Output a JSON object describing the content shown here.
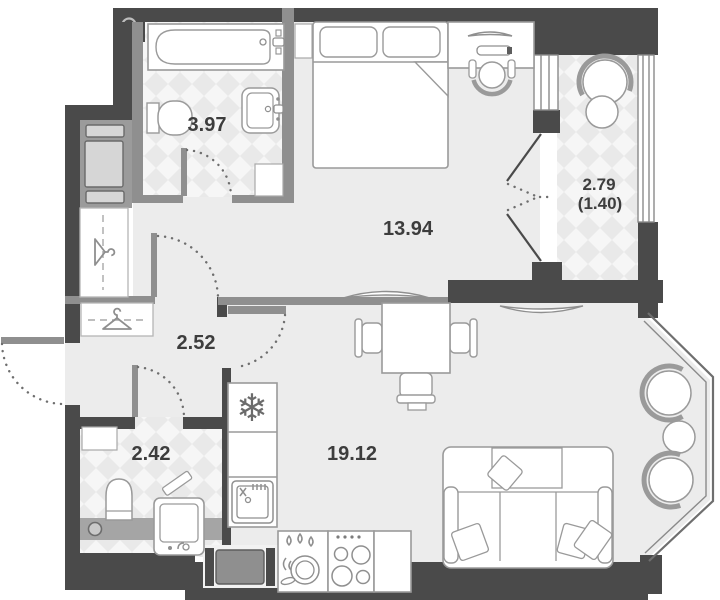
{
  "plan": {
    "type": "apartment-floor-plan",
    "rooms": [
      {
        "id": "bathroom",
        "area": "3.97"
      },
      {
        "id": "bedroom",
        "area": "13.94"
      },
      {
        "id": "balcony",
        "area": "2.79",
        "area_reduced": "(1.40)"
      },
      {
        "id": "hallway",
        "area": "2.52"
      },
      {
        "id": "wc",
        "area": "2.42"
      },
      {
        "id": "living-kitchen",
        "area": "19.12"
      }
    ],
    "icons": {
      "freezer": "❄"
    },
    "colors": {
      "wall": "#4a4a4a",
      "partition": "#8f8f8f",
      "floor": "#ececec",
      "tile_bg": "#f6f6f6",
      "tile_diamond": "#e9e9e9",
      "furniture_stroke": "#9a9a9a",
      "label": "#3d3d3d"
    }
  }
}
